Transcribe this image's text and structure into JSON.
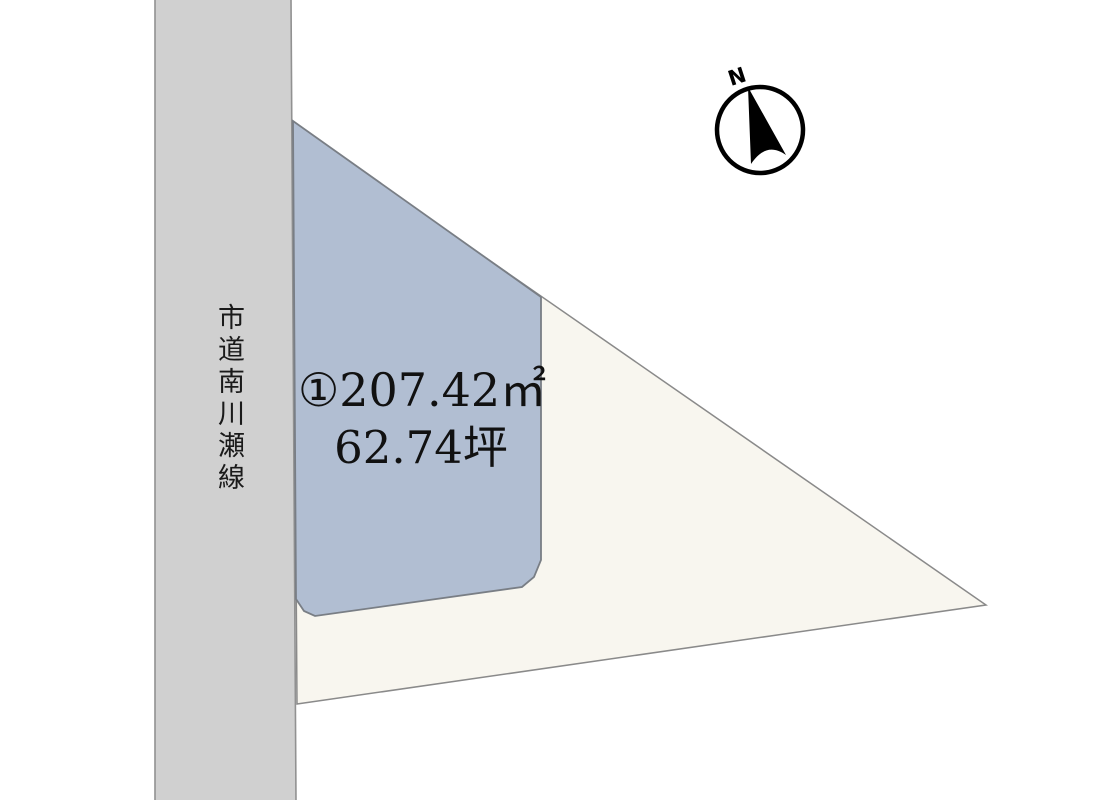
{
  "canvas": {
    "width": 1100,
    "height": 800,
    "background_color": "#ffffff"
  },
  "road": {
    "label": "市道南川瀬線",
    "fill_color": "#d0d0d0",
    "edge_color": "#919191"
  },
  "parcel_outline": {
    "fill_color": "#f8f6ef",
    "edge_color": "#8a8a8a"
  },
  "parcel_1": {
    "area_label": "①207.42㎡",
    "tsubo_label": "62.74坪",
    "fill_color": "#b1bed2",
    "edge_color": "#797e85"
  },
  "compass": {
    "north_label": "N",
    "color": "#000000"
  }
}
